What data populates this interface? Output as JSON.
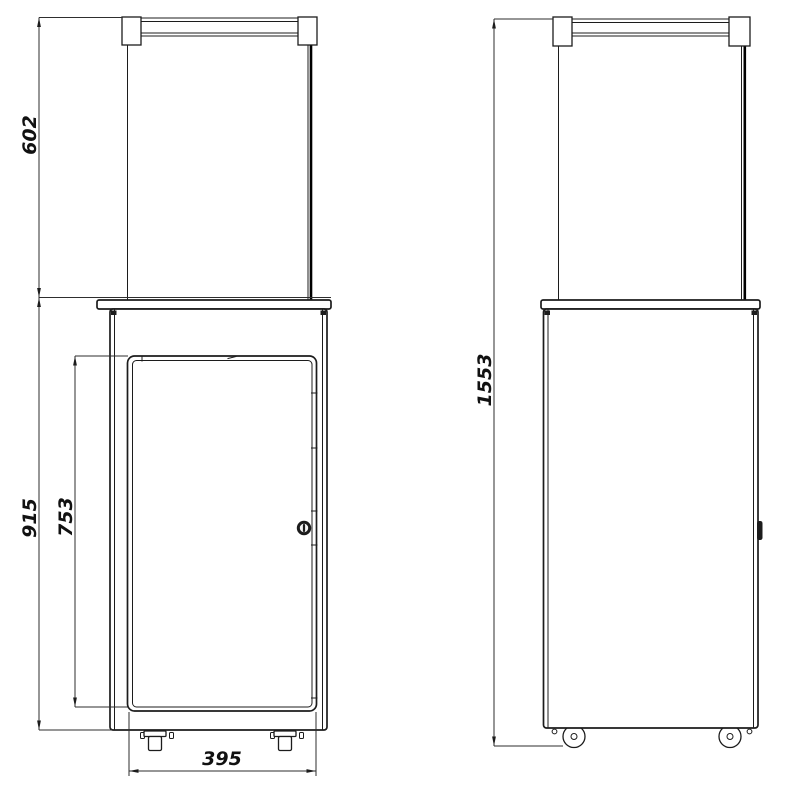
{
  "colors": {
    "background": "#ffffff",
    "line": "#1c1c1c",
    "line_heavy": "#000000",
    "text": "#111111"
  },
  "drawing": {
    "front_view": {
      "dimensions": {
        "glass_section_height": "602",
        "body_height": "915",
        "door_height": "753",
        "base_width": "395"
      }
    },
    "side_view": {
      "dimensions": {
        "total_height": "1553"
      }
    }
  }
}
